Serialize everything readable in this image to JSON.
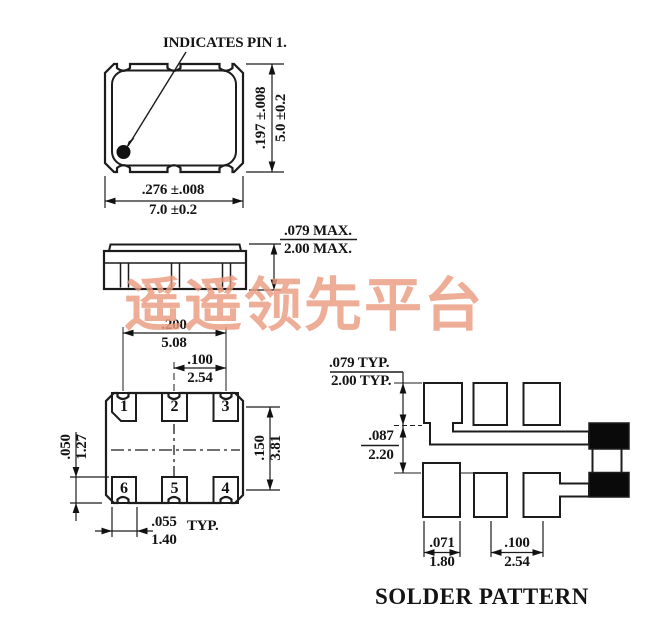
{
  "watermark": {
    "text": "遥遥领先平台",
    "color": "#ea9c80"
  },
  "top_view": {
    "pin1_label": "INDICATES PIN 1.",
    "dim_height_in": ".197 ±.008",
    "dim_height_mm": "5.0 ±0.2",
    "dim_width_in": ".276 ±.008",
    "dim_width_mm": "7.0 ±0.2"
  },
  "side_view": {
    "dim_height_in": ".079 MAX.",
    "dim_height_mm": "2.00 MAX."
  },
  "bottom_view": {
    "pins": [
      "1",
      "2",
      "3",
      "6",
      "5",
      "4"
    ],
    "dim_span_in": ".200",
    "dim_span_mm": "5.08",
    "dim_pitch_in": ".100",
    "dim_pitch_mm": "2.54",
    "dim_pad_height_in": ".050",
    "dim_pad_height_mm": "1.27",
    "dim_row_spacing_in": ".150",
    "dim_row_spacing_mm": "3.81",
    "dim_pad_width_in": ".055",
    "dim_pad_width_mm": "1.40",
    "typ_label": "TYP."
  },
  "solder_pattern": {
    "title": "SOLDER PATTERN",
    "dim_pad_height_in": ".079 TYP.",
    "dim_pad_height_mm": "2.00 TYP.",
    "dim_gap_in": ".087",
    "dim_gap_mm": "2.20",
    "dim_pad_width_in": ".071",
    "dim_pad_width_mm": "1.80",
    "dim_pitch_in": ".100",
    "dim_pitch_mm": "2.54"
  }
}
